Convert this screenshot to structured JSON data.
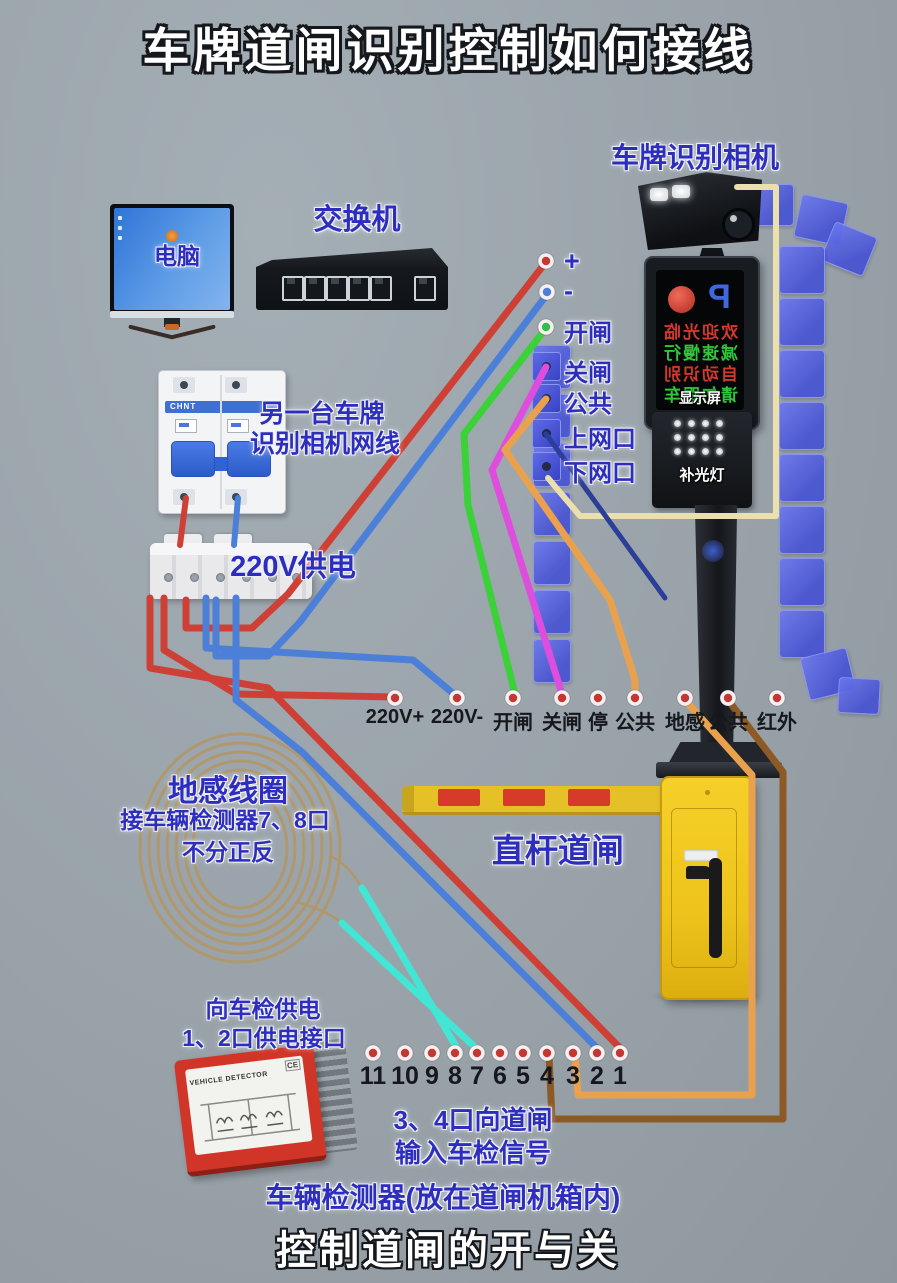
{
  "page": {
    "title": "车牌道闸识别控制如何接线",
    "footer": "控制道闸的开与关"
  },
  "labels": {
    "camera": "车牌识别相机",
    "computer": "电脑",
    "switch": "交换机",
    "breaker_note_1": "另一台车牌",
    "breaker_note_2": "识别相机网线",
    "breaker_brand": "CHNT",
    "power": "220V供电",
    "coil_1": "地感线圈",
    "coil_2": "接车辆检测器7、8口",
    "coil_3": "不分正反",
    "barrier": "直杆道闸",
    "detector_note_1": "向车检供电",
    "detector_note_2": "1、2口供电接口",
    "signal_note_1": "3、4口向道闸",
    "signal_note_2": "输入车检信号",
    "detector_caption": "车辆检测器(放在道闸机箱内)"
  },
  "camera_unit": {
    "screen_p": "P",
    "display_label": "显示屏",
    "fill_light_label": "补光灯",
    "screen_lines": [
      "欢迎光临",
      "减速慢行",
      "自动识别",
      "请勿跟车"
    ]
  },
  "detector_device": {
    "title": "VEHICLE DETECTOR",
    "ce": "CE"
  },
  "camera_terminals": [
    "+",
    "-",
    "开闸",
    "关闸",
    "公共",
    "上网口",
    "下网口"
  ],
  "gate_terminals": [
    "220V+",
    "220V-",
    "开闸",
    "关闸",
    "停",
    "公共",
    "地感",
    "公共",
    "红外"
  ],
  "detector_terminals": [
    "11",
    "10",
    "9",
    "8",
    "7",
    "6",
    "5",
    "4",
    "3",
    "2",
    "1"
  ],
  "colors": {
    "bg": "#99a2a9",
    "label_blue": "#2e2ebe",
    "wire_red": "#ce4036",
    "wire_blue": "#4c80d8",
    "wire_green": "#3bd139",
    "wire_magenta": "#de4ede",
    "wire_orange": "#eaa14e",
    "wire_brown": "#8d5a26",
    "wire_cyan": "#43e5d5",
    "wire_beige": "#ebdfae",
    "wire_navy": "#2c3f98",
    "coil_tan": "#b0976a",
    "panel_blue": "#4753d2",
    "cabinet_yellow": "#eec41c",
    "arm_red": "#d63a28",
    "dot_red": "#c43732",
    "screen_red": "#d2392c",
    "screen_green": "#2fc63a",
    "p_blue": "#3f67de"
  }
}
